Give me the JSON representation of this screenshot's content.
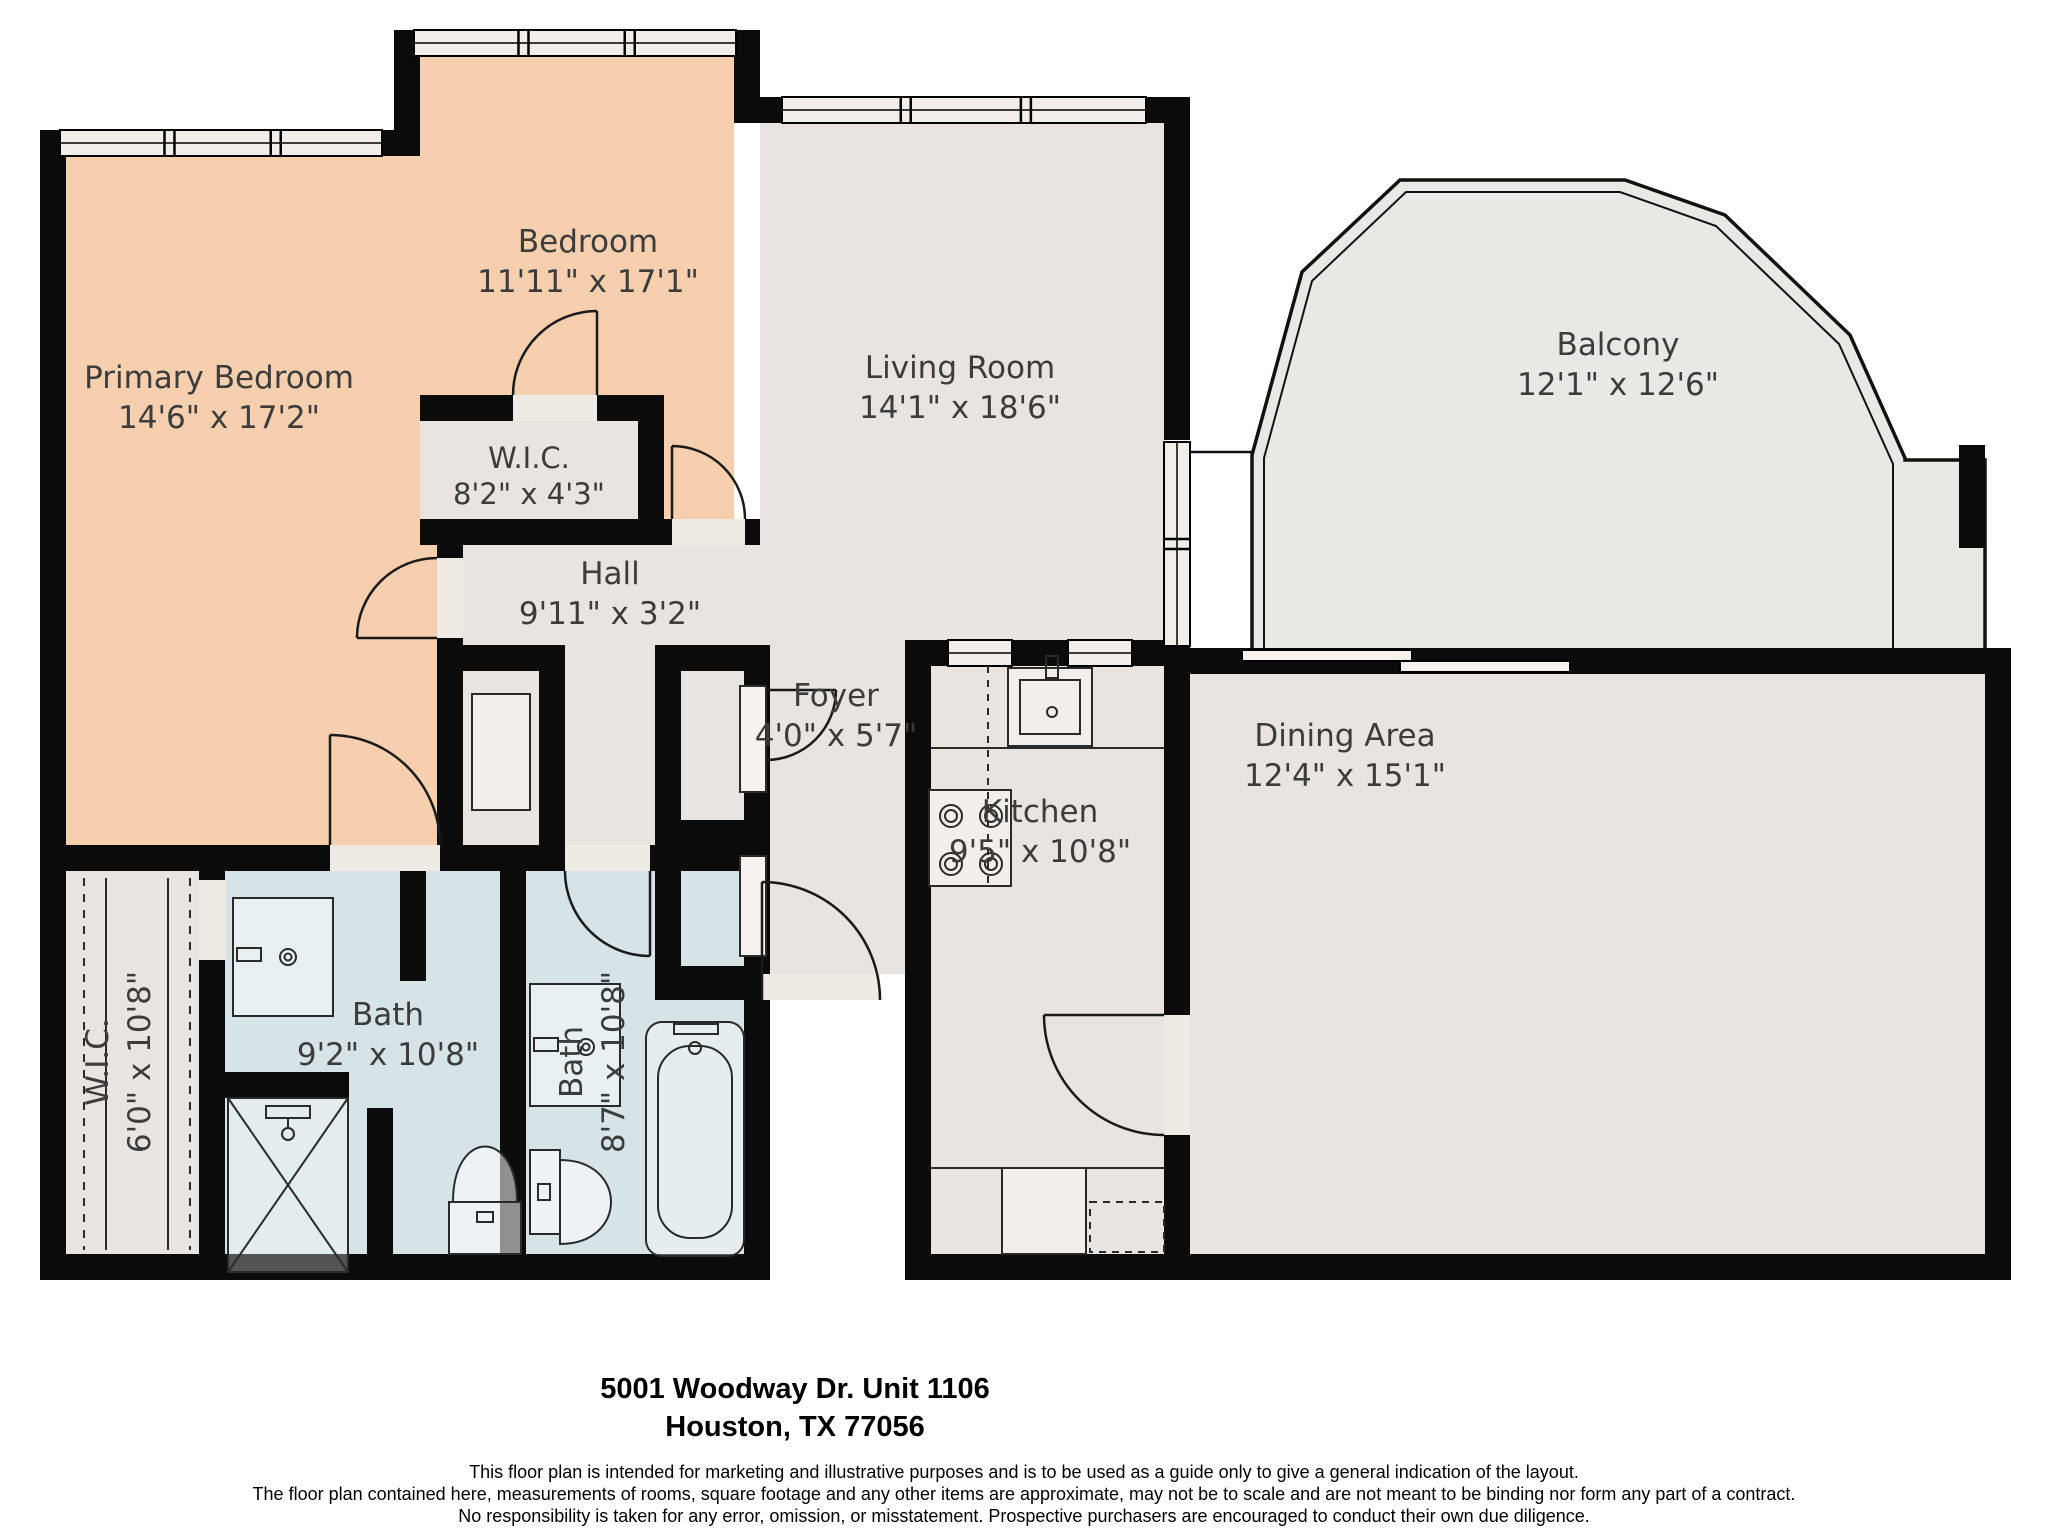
{
  "document": {
    "type": "floor-plan",
    "address_line1": "5001 Woodway Dr. Unit 1106",
    "address_line2": "Houston, TX 77056",
    "disclaimer_lines": [
      "This floor plan is intended for marketing and illustrative purposes and is to be used as a guide only to give a general indication of the layout.",
      "The floor plan contained here, measurements of rooms, square footage and any other items are approximate, may not be to scale and are not meant to be binding nor form any part of a contract.",
      "No responsibility is taken for any error, omission, or misstatement. Prospective purchasers are encouraged to conduct their own due diligence."
    ]
  },
  "colors": {
    "wall": "#0b0b0b",
    "bedroom_fill": "#f5cfae",
    "room_fill": "#e9e4df",
    "bath_fill": "#d7e4e7",
    "balcony_fill": "#eae8e5",
    "window_fill": "#f1ede8",
    "threshold_fill": "#efeae3",
    "fixture_stroke": "#2a2a2a",
    "fixture_light": "#f2eee9",
    "label_color": "#3c3c3c",
    "footer_color": "#000000"
  },
  "rooms": [
    {
      "id": "primary-bedroom",
      "label": "Primary Bedroom",
      "dims": "14'6\" x 17'2\"",
      "cx": 219,
      "cy": 388
    },
    {
      "id": "bedroom",
      "label": "Bedroom",
      "dims": "11'11\" x 17'1\"",
      "cx": 588,
      "cy": 252
    },
    {
      "id": "wic-bedroom",
      "label": "W.I.C.",
      "dims": "8'2\" x 4'3\"",
      "cx": 529,
      "cy": 468,
      "small": true
    },
    {
      "id": "hall",
      "label": "Hall",
      "dims": "9'11\" x 3'2\"",
      "cx": 610,
      "cy": 584
    },
    {
      "id": "living-room",
      "label": "Living Room",
      "dims": "14'1\" x 18'6\"",
      "cx": 960,
      "cy": 378
    },
    {
      "id": "balcony",
      "label": "Balcony",
      "dims": "12'1\" x 12'6\"",
      "cx": 1618,
      "cy": 355
    },
    {
      "id": "foyer",
      "label": "Foyer",
      "dims": "4'0\" x 5'7\"",
      "cx": 836,
      "cy": 706
    },
    {
      "id": "kitchen",
      "label": "Kitchen",
      "dims": "9'5\" x 10'8\"",
      "cx": 1040,
      "cy": 822
    },
    {
      "id": "dining-area",
      "label": "Dining Area",
      "dims": "12'4\" x 15'1\"",
      "cx": 1345,
      "cy": 746
    },
    {
      "id": "bath-primary",
      "label": "Bath",
      "dims": "9'2\" x 10'8\"",
      "cx": 388,
      "cy": 1025
    },
    {
      "id": "bath-hall",
      "label": "Bath",
      "dims": "8'7\" x 10'8\"",
      "cx": 602,
      "cy": 1062,
      "rotated": true
    },
    {
      "id": "wic-primary",
      "label": "W.I.C.",
      "dims": "6'0\" x 10'8\"",
      "cx": 128,
      "cy": 1062,
      "rotated": true
    }
  ]
}
